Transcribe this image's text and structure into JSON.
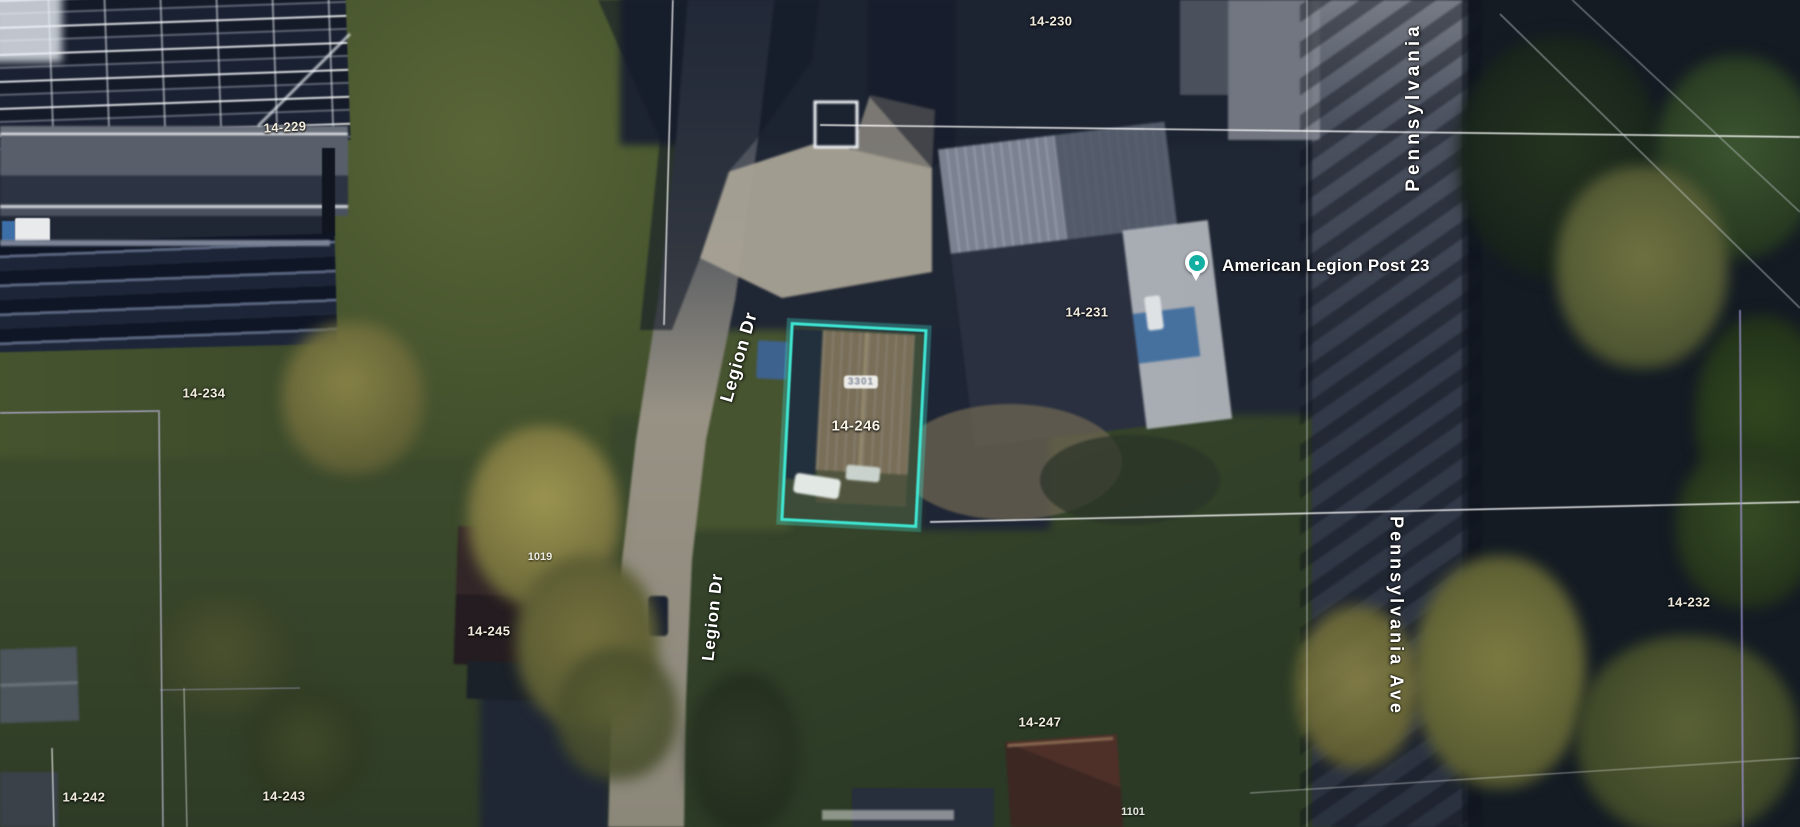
{
  "map": {
    "view_type": "satellite imagery with parcel overlay",
    "highlight_color": "#3fe6d2",
    "parcel_line_color": "#ffffff",
    "parcel_line_alt_color": "#9b90cf"
  },
  "place": {
    "name": "American Legion Post 23",
    "marker_color": "#11b0a2"
  },
  "streets": {
    "legion_dr_upper": "Legion Dr",
    "legion_dr_lower": "Legion Dr",
    "pennsylvania_upper": "Pennsylvania",
    "pennsylvania_ave": "Pennsylvania Ave"
  },
  "highlighted_parcel": {
    "text": "14-246"
  },
  "parcels": [
    {
      "text": "14-229"
    },
    {
      "text": "14-230"
    },
    {
      "text": "14-231"
    },
    {
      "text": "14-232"
    },
    {
      "text": "14-234"
    },
    {
      "text": "14-242"
    },
    {
      "text": "14-243"
    },
    {
      "text": "14-245"
    },
    {
      "text": "14-247"
    }
  ],
  "addresses": [
    {
      "text": "1019"
    },
    {
      "text": "1101"
    },
    {
      "text": "3301"
    }
  ]
}
